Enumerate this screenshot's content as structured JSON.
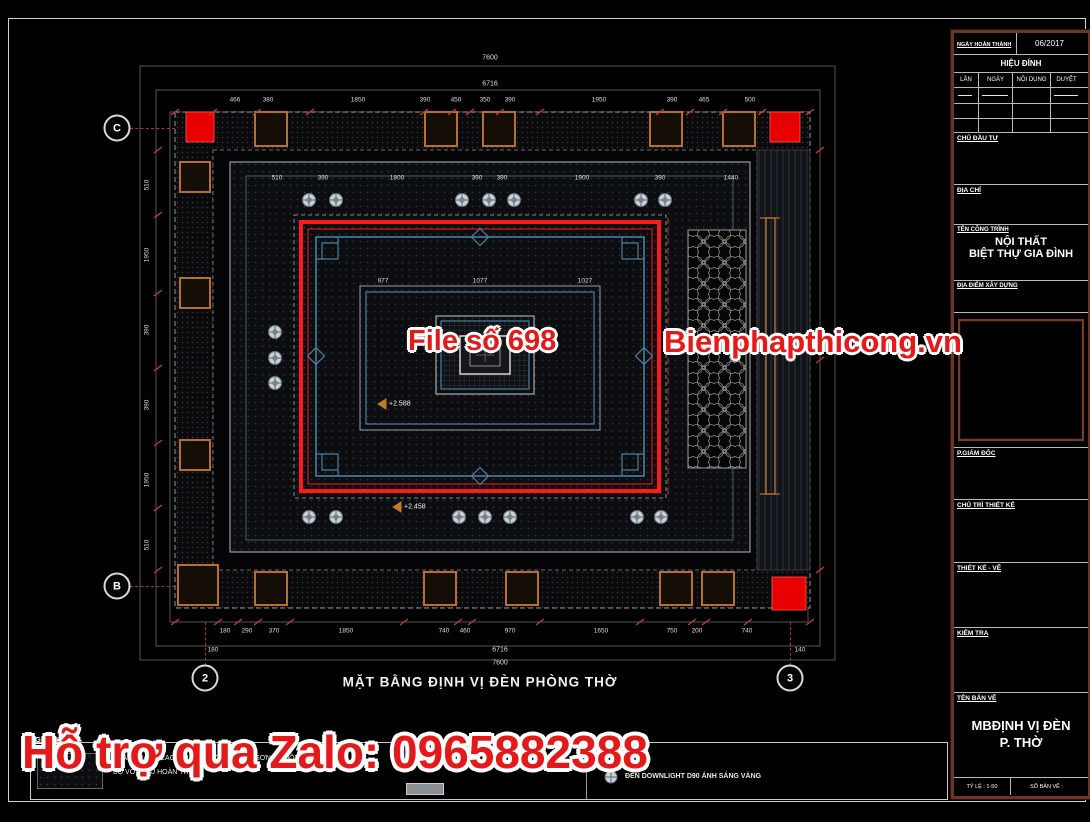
{
  "colors": {
    "frame_red": "#ff1a1a",
    "ornate_blue": "#4d7f9e",
    "column_orange": "#b5702f",
    "watermark_red": "#e41a1a",
    "titleblock_brown": "#6e3322"
  },
  "watermarks": {
    "file_no": "File số 698",
    "site": "Bienphapthicong.vn",
    "support": "Hỗ trợ qua Zalo: 0965882388"
  },
  "drawing": {
    "title": "MẶT BẰNG ĐỊNH VỊ ĐÈN PHÒNG THỜ",
    "grid_bubbles": {
      "c": "C",
      "b": "B",
      "two": "2",
      "three": "3"
    },
    "levels": {
      "upper": "+2.588",
      "lower": "+2.458"
    },
    "dimensions": {
      "top_total": "7600",
      "top_inner": "6716",
      "top_chain": [
        "466",
        "380",
        "1850",
        "390",
        "450",
        "350",
        "390",
        "1950",
        "390",
        "465",
        "500"
      ],
      "inside_top_chain": [
        "510",
        "390",
        "1800",
        "390",
        "390",
        "1900",
        "390",
        "1440"
      ],
      "inner_widths": [
        "977",
        "1077",
        "1027"
      ],
      "bottom_chain": [
        "180",
        "290",
        "370",
        "1850",
        "740",
        "460",
        "970",
        "1650",
        "750",
        "200",
        "740"
      ],
      "bottom_inner": "6716",
      "bottom_total": "7600",
      "bottom_side_left": "180",
      "bottom_side_right": "140",
      "left_chain": [
        "510",
        "1950",
        "390",
        "390",
        "1950",
        "510"
      ]
    },
    "legend": {
      "note_label": "GHI CHÚ",
      "note_line1": "TRẦN THẠCH CAO KHUNG XƯƠNG CHÌM, SƠN BẢ ĐỒNG",
      "note_line2": "BỘ VỚI MÀU HOÀN THIỆN",
      "light_label": "ĐÈN DOWNLIGHT D90 ÁNH SÁNG VÀNG"
    }
  },
  "title_block": {
    "date_label": "NGÀY HOÀN THÀNH",
    "date_value": "06/2017",
    "revision_title": "HIỆU ĐÍNH",
    "rev_col_1": "LẦN",
    "rev_col_2": "NGÀY",
    "rev_col_3": "NỘI DUNG",
    "rev_col_4": "DUYỆT",
    "investor_label": "CHỦ ĐẦU TƯ",
    "address_label": "ĐỊA CHỈ",
    "project_label": "TÊN CÔNG TRÌNH",
    "project_name_1": "NỘI THẤT",
    "project_name_2": "BIỆT THỰ GIA ĐÌNH",
    "location_label": "ĐỊA ĐIỂM XÂY DỰNG",
    "director_label": "P.GIÁM ĐỐC",
    "lead_label": "CHỦ TRÌ THIẾT KẾ",
    "design_label": "THIẾT KẾ - VẼ",
    "check_label": "KIỂM TRA",
    "sheet_label": "TÊN BẢN VẼ",
    "sheet_name_1": "MBĐỊNH VỊ ĐÈN",
    "sheet_name_2": "P. THỜ",
    "scale_label": "TỶ LỆ : 1-50",
    "number_label": "SỐ BẢN VẼ :"
  }
}
